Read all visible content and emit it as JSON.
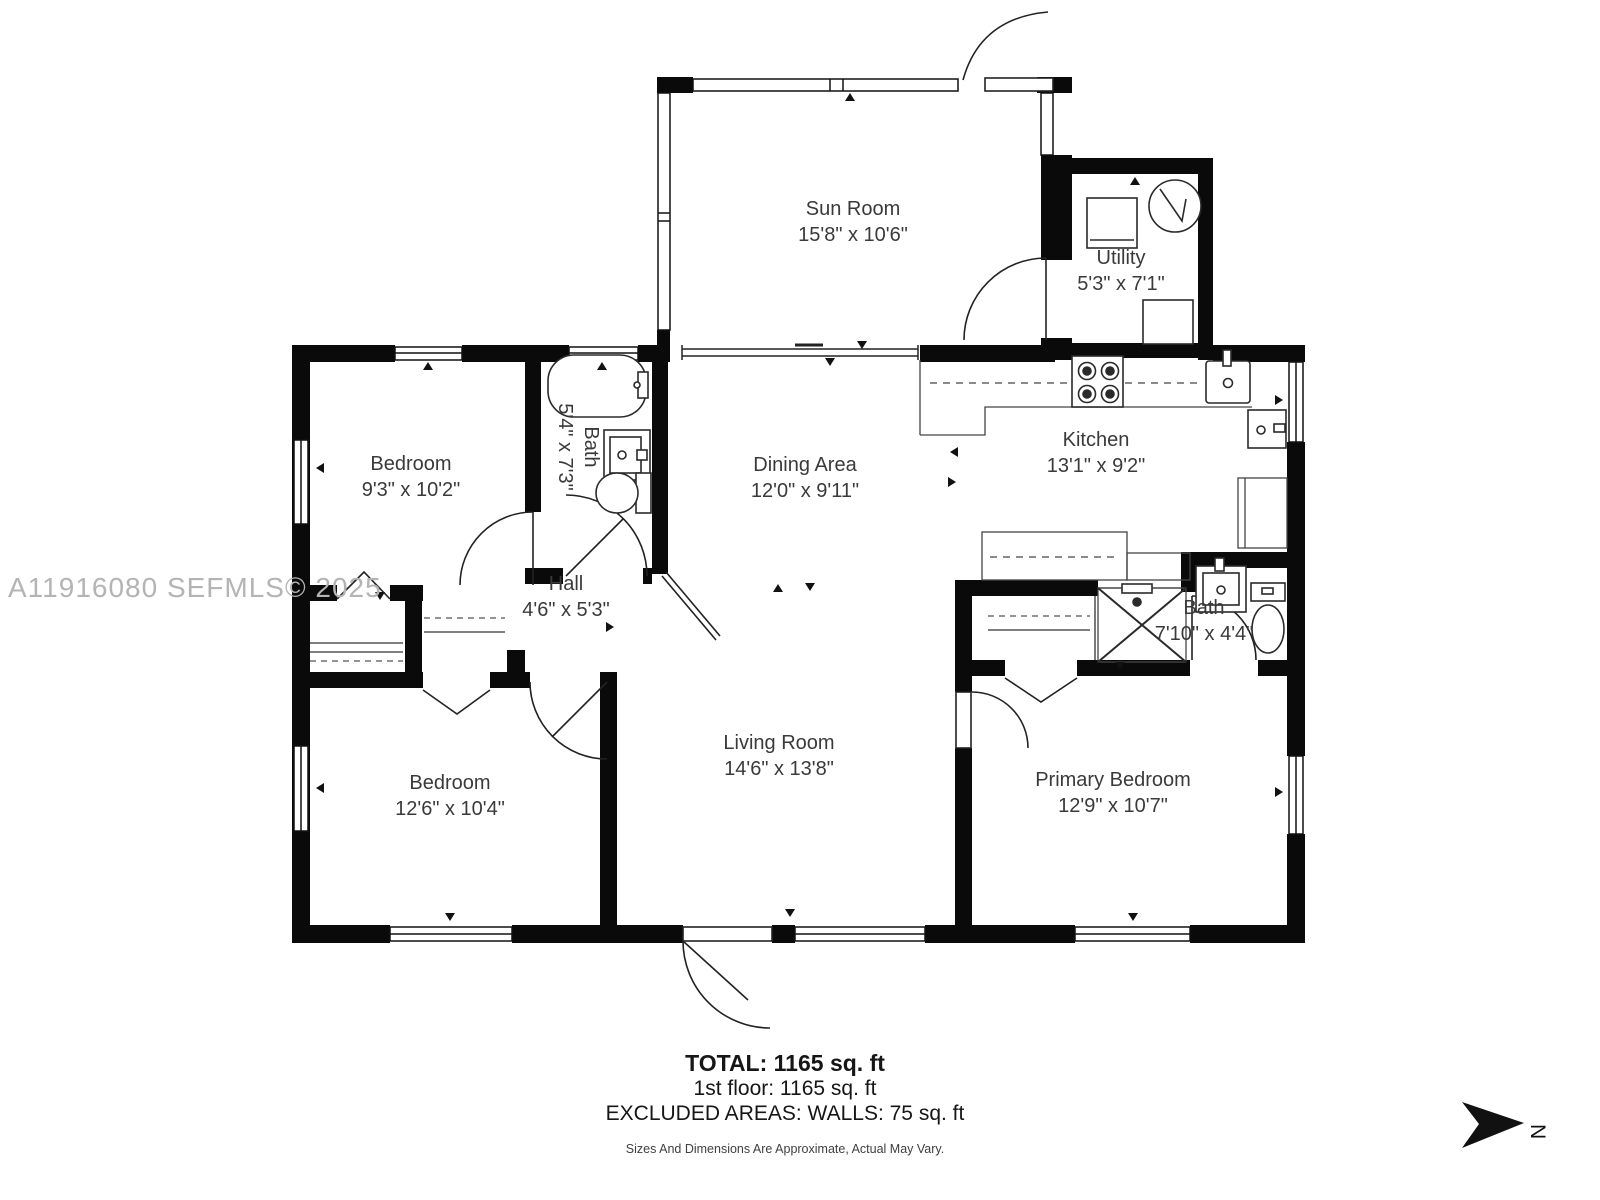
{
  "watermark": "A11916080  SEFMLS© 2025",
  "rooms": [
    {
      "name": "Sun Room",
      "dims": "15'8\" x 10'6\""
    },
    {
      "name": "Utility",
      "dims": "5'3\" x 7'1\""
    },
    {
      "name": "Bedroom",
      "dims": "9'3\" x 10'2\""
    },
    {
      "name": "Bath",
      "dims": "5'4\" x 7'3\""
    },
    {
      "name": "Dining Area",
      "dims": "12'0\" x 9'11\""
    },
    {
      "name": "Kitchen",
      "dims": "13'1\" x 9'2\""
    },
    {
      "name": "Hall",
      "dims": "4'6\" x 5'3\""
    },
    {
      "name": "Bedroom",
      "dims": "12'6\" x 10'4\""
    },
    {
      "name": "Living Room",
      "dims": "14'6\" x 13'8\""
    },
    {
      "name": "Primary Bedroom",
      "dims": "12'9\" x 10'7\""
    },
    {
      "name": "Bath",
      "dims": "7'10\" x 4'4\""
    }
  ],
  "summary": {
    "total": "TOTAL: 1165 sq. ft",
    "floor": "1st floor: 1165 sq. ft",
    "excluded": "EXCLUDED AREAS: WALLS: 75 sq. ft",
    "disclaimer": "Sizes And Dimensions Are Approximate, Actual May Vary."
  },
  "compass": {
    "label": "N"
  },
  "colors": {
    "wall": "#0a0a0a",
    "fixture": "#2a2a2a",
    "label": "#3a3a3a",
    "watermark": "#b4b4b4"
  }
}
